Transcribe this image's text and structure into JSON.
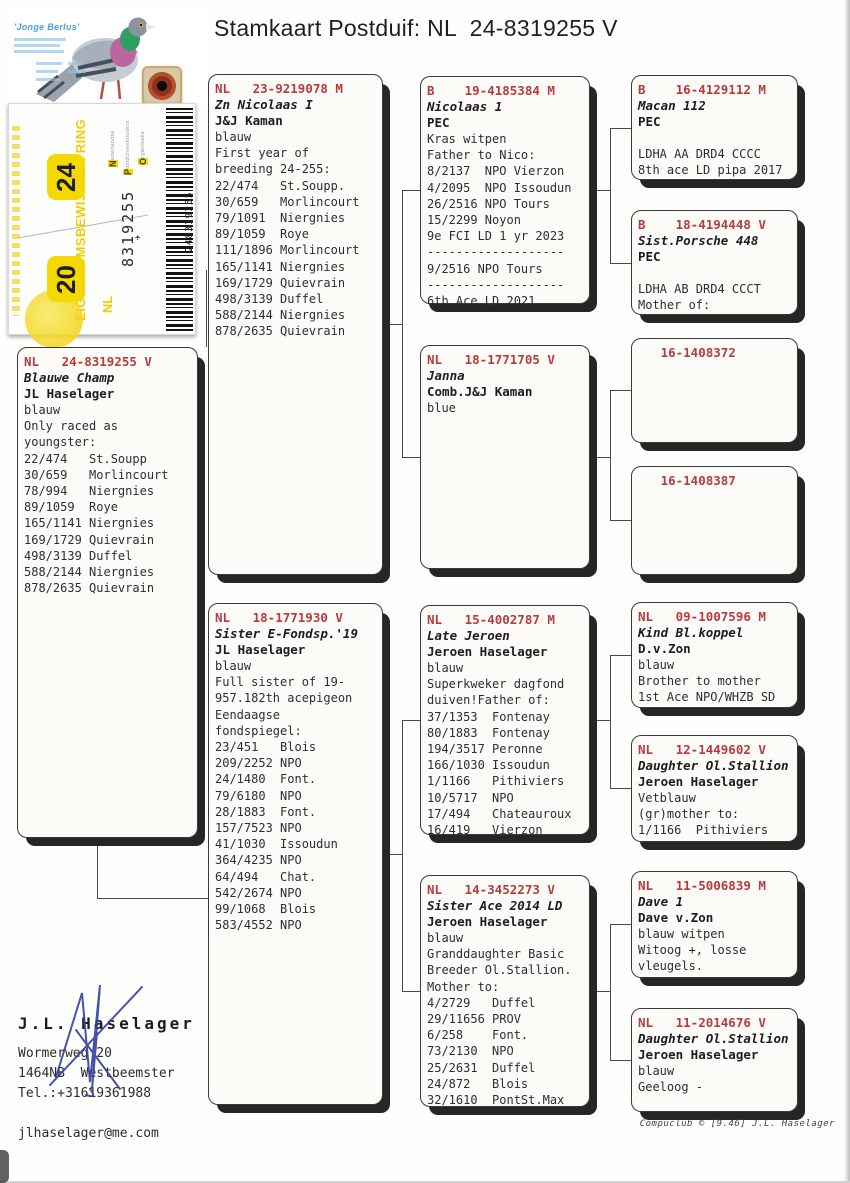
{
  "title": "Stamkaart Postduif: NL  24-8319255 V",
  "photo": {
    "caption": "'Jonge Berlus'"
  },
  "ring_card": {
    "ownership_label": "EIGENDOMSBEWIJS V/A RING",
    "year_top": "24",
    "year_bottom": "20",
    "org_words": [
      "Nederlandse",
      "Postduivenhouders",
      "Organisatie"
    ],
    "ring_number": "8319255",
    "country": "NL",
    "plane_icon": "✈",
    "barcode_number": "248319255"
  },
  "boxes": {
    "main": {
      "header": "NL   24-8319255 V",
      "name": "Blauwe Champ",
      "owner": "JL Haselager",
      "body": "blauw\nOnly raced as\nyoungster:\n22/474   St.Soupp\n30/659   Morlincourt\n78/994   Niergnies\n89/1059  Roye\n165/1141 Niergnies\n169/1729 Quievrain\n498/3139 Duffel\n588/2144 Niergnies\n878/2635 Quievrain"
    },
    "father": {
      "header": "NL   23-9219078 M",
      "name": "Zn Nicolaas I",
      "owner": "J&J Kaman",
      "body": "blauw\nFirst year of\nbreeding 24-255:\n22/474   St.Soupp.\n30/659   Morlincourt\n79/1091  Niergnies\n89/1059  Roye\n111/1896 Morlincourt\n165/1141 Niergnies\n169/1729 Quievrain\n498/3139 Duffel\n588/2144 Niergnies\n878/2635 Quievrain"
    },
    "mother": {
      "header": "NL   18-1771930 V",
      "name": "Sister E-Fondsp.'19",
      "owner": "JL Haselager",
      "body": "blauw\nFull sister of 19-\n957.182th acepigeon\nEendaagse\nfondspiegel:\n23/451   Blois\n209/2252 NPO\n24/1480  Font.\n79/6180  NPO\n28/1883  Font.\n157/7523 NPO\n41/1030  Issoudun\n364/4235 NPO\n64/494   Chat.\n542/2674 NPO\n99/1068  Blois\n583/4552 NPO"
    },
    "gp1": {
      "header": "B    19-4185384 M",
      "name": "Nicolaas 1",
      "owner": "PEC",
      "body": "Kras witpen\nFather to Nico:\n8/2137  NPO Vierzon\n4/2095  NPO Issoudun\n26/2516 NPO Tours\n15/2299 Noyon\n9e FCI LD 1 yr 2023\n-------------------\n9/2516 NPO Tours\n-------------------\n6th Ace LD 2021"
    },
    "gp2": {
      "header": "NL   18-1771705 V",
      "name": "Janna",
      "owner": "Comb.J&J Kaman",
      "body": "blue"
    },
    "gp3": {
      "header": "NL   15-4002787 M",
      "name": "Late Jeroen",
      "owner": "Jeroen Haselager",
      "body": "blauw\nSuperkweker dagfond\nduiven!Father of:\n37/1353  Fontenay\n80/1883  Fontenay\n194/3517 Peronne\n166/1030 Issoudun\n1/1166   Pithiviers\n10/5717  NPO\n17/494   Chateauroux\n16/419   Vierzon"
    },
    "gp4": {
      "header": "NL   14-3452273 V",
      "name": "Sister Ace 2014 LD",
      "owner": "Jeroen Haselager",
      "body": "blauw\nGranddaughter Basic\nBreeder Ol.Stallion.\nMother to:\n4/2729   Duffel\n29/11656 PROV\n6/258    Font.\n73/2130  NPO\n25/2631  Duffel\n24/872   Blois\n32/1610  PontSt.Max"
    },
    "ggp1": {
      "header": "B    16-4129112 M",
      "name": "Macan 112",
      "owner": "PEC",
      "body": "\nLDHA AA DRD4 CCCC\n8th ace LD pipa 2017"
    },
    "ggp2": {
      "header": "B    18-4194448 V",
      "name": "Sist.Porsche 448",
      "owner": "PEC",
      "body": "\nLDHA AB DRD4 CCCT\nMother of:"
    },
    "ggp3": {
      "header": "   16-1408372",
      "name": "",
      "owner": "",
      "body": ""
    },
    "ggp4": {
      "header": "   16-1408387",
      "name": "",
      "owner": "",
      "body": ""
    },
    "ggp5": {
      "header": "NL   09-1007596 M",
      "name": "Kind Bl.koppel",
      "owner": "D.v.Zon",
      "body": "blauw\nBrother to mother\n1st Ace NPO/WHZB SD"
    },
    "ggp6": {
      "header": "NL   12-1449602 V",
      "name": "Daughter Ol.Stallion",
      "owner": "Jeroen Haselager",
      "body": "Vetblauw\n(gr)mother to:\n1/1166  Pithiviers"
    },
    "ggp7": {
      "header": "NL   11-5006839 M",
      "name": "Dave 1",
      "owner": "Dave v.Zon",
      "body": "blauw witpen\nWitoog +, losse\nvleugels."
    },
    "ggp8": {
      "header": "NL   11-2014676 V",
      "name": "Daughter Ol.Stallion",
      "owner": "Jeroen Haselager",
      "body": "blauw\nGeeloog -"
    }
  },
  "owner_block": {
    "name": "J.L. Haselager",
    "details": "Wormerweg 20\n1464NB  Westbeemster\nTel.:+31619361988\n\njlhaselager@me.com"
  },
  "footer": {
    "text": "Compuclub © [9.46]  J.L. Haselager"
  }
}
